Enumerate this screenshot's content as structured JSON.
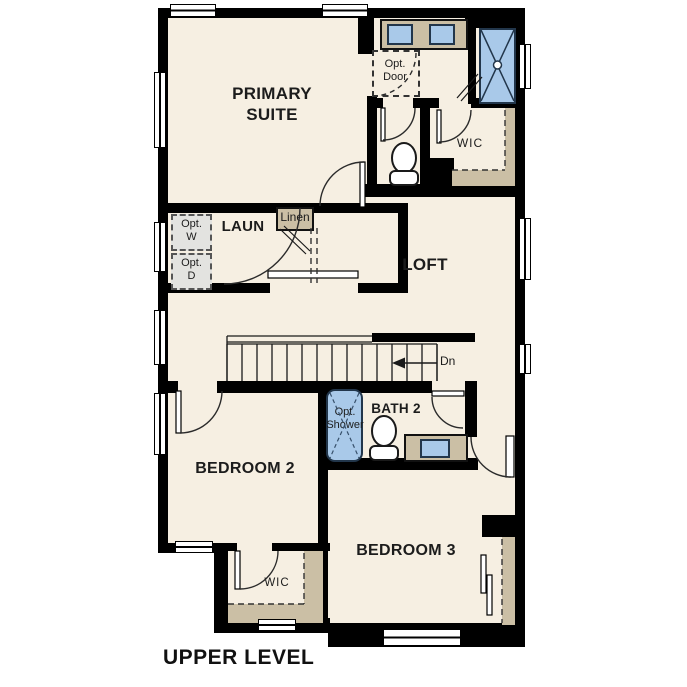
{
  "title": "UPPER LEVEL",
  "rooms": {
    "primary_suite": "PRIMARY SUITE",
    "loft": "LOFT",
    "laundry": "LAUN",
    "bedroom_2": "BEDROOM 2",
    "bath_2": "BATH 2",
    "bedroom_3": "BEDROOM 3",
    "primary_wic": "WIC",
    "bedroom2_wic": "WIC"
  },
  "annotations": {
    "optional_door": "Opt. Door",
    "optional_washer": "Opt. W",
    "optional_dryer": "Opt. D",
    "optional_shower": "Opt. Shower",
    "linen": "Linen",
    "stairs_down": "Dn"
  },
  "colors": {
    "wall": "#000000",
    "floor": "#f6efe2",
    "counter_tan": "#cbbfa5",
    "fixture_blue": "#a9c9e9",
    "optional_item_gray": "#e3e3e0",
    "background": "#ffffff"
  }
}
